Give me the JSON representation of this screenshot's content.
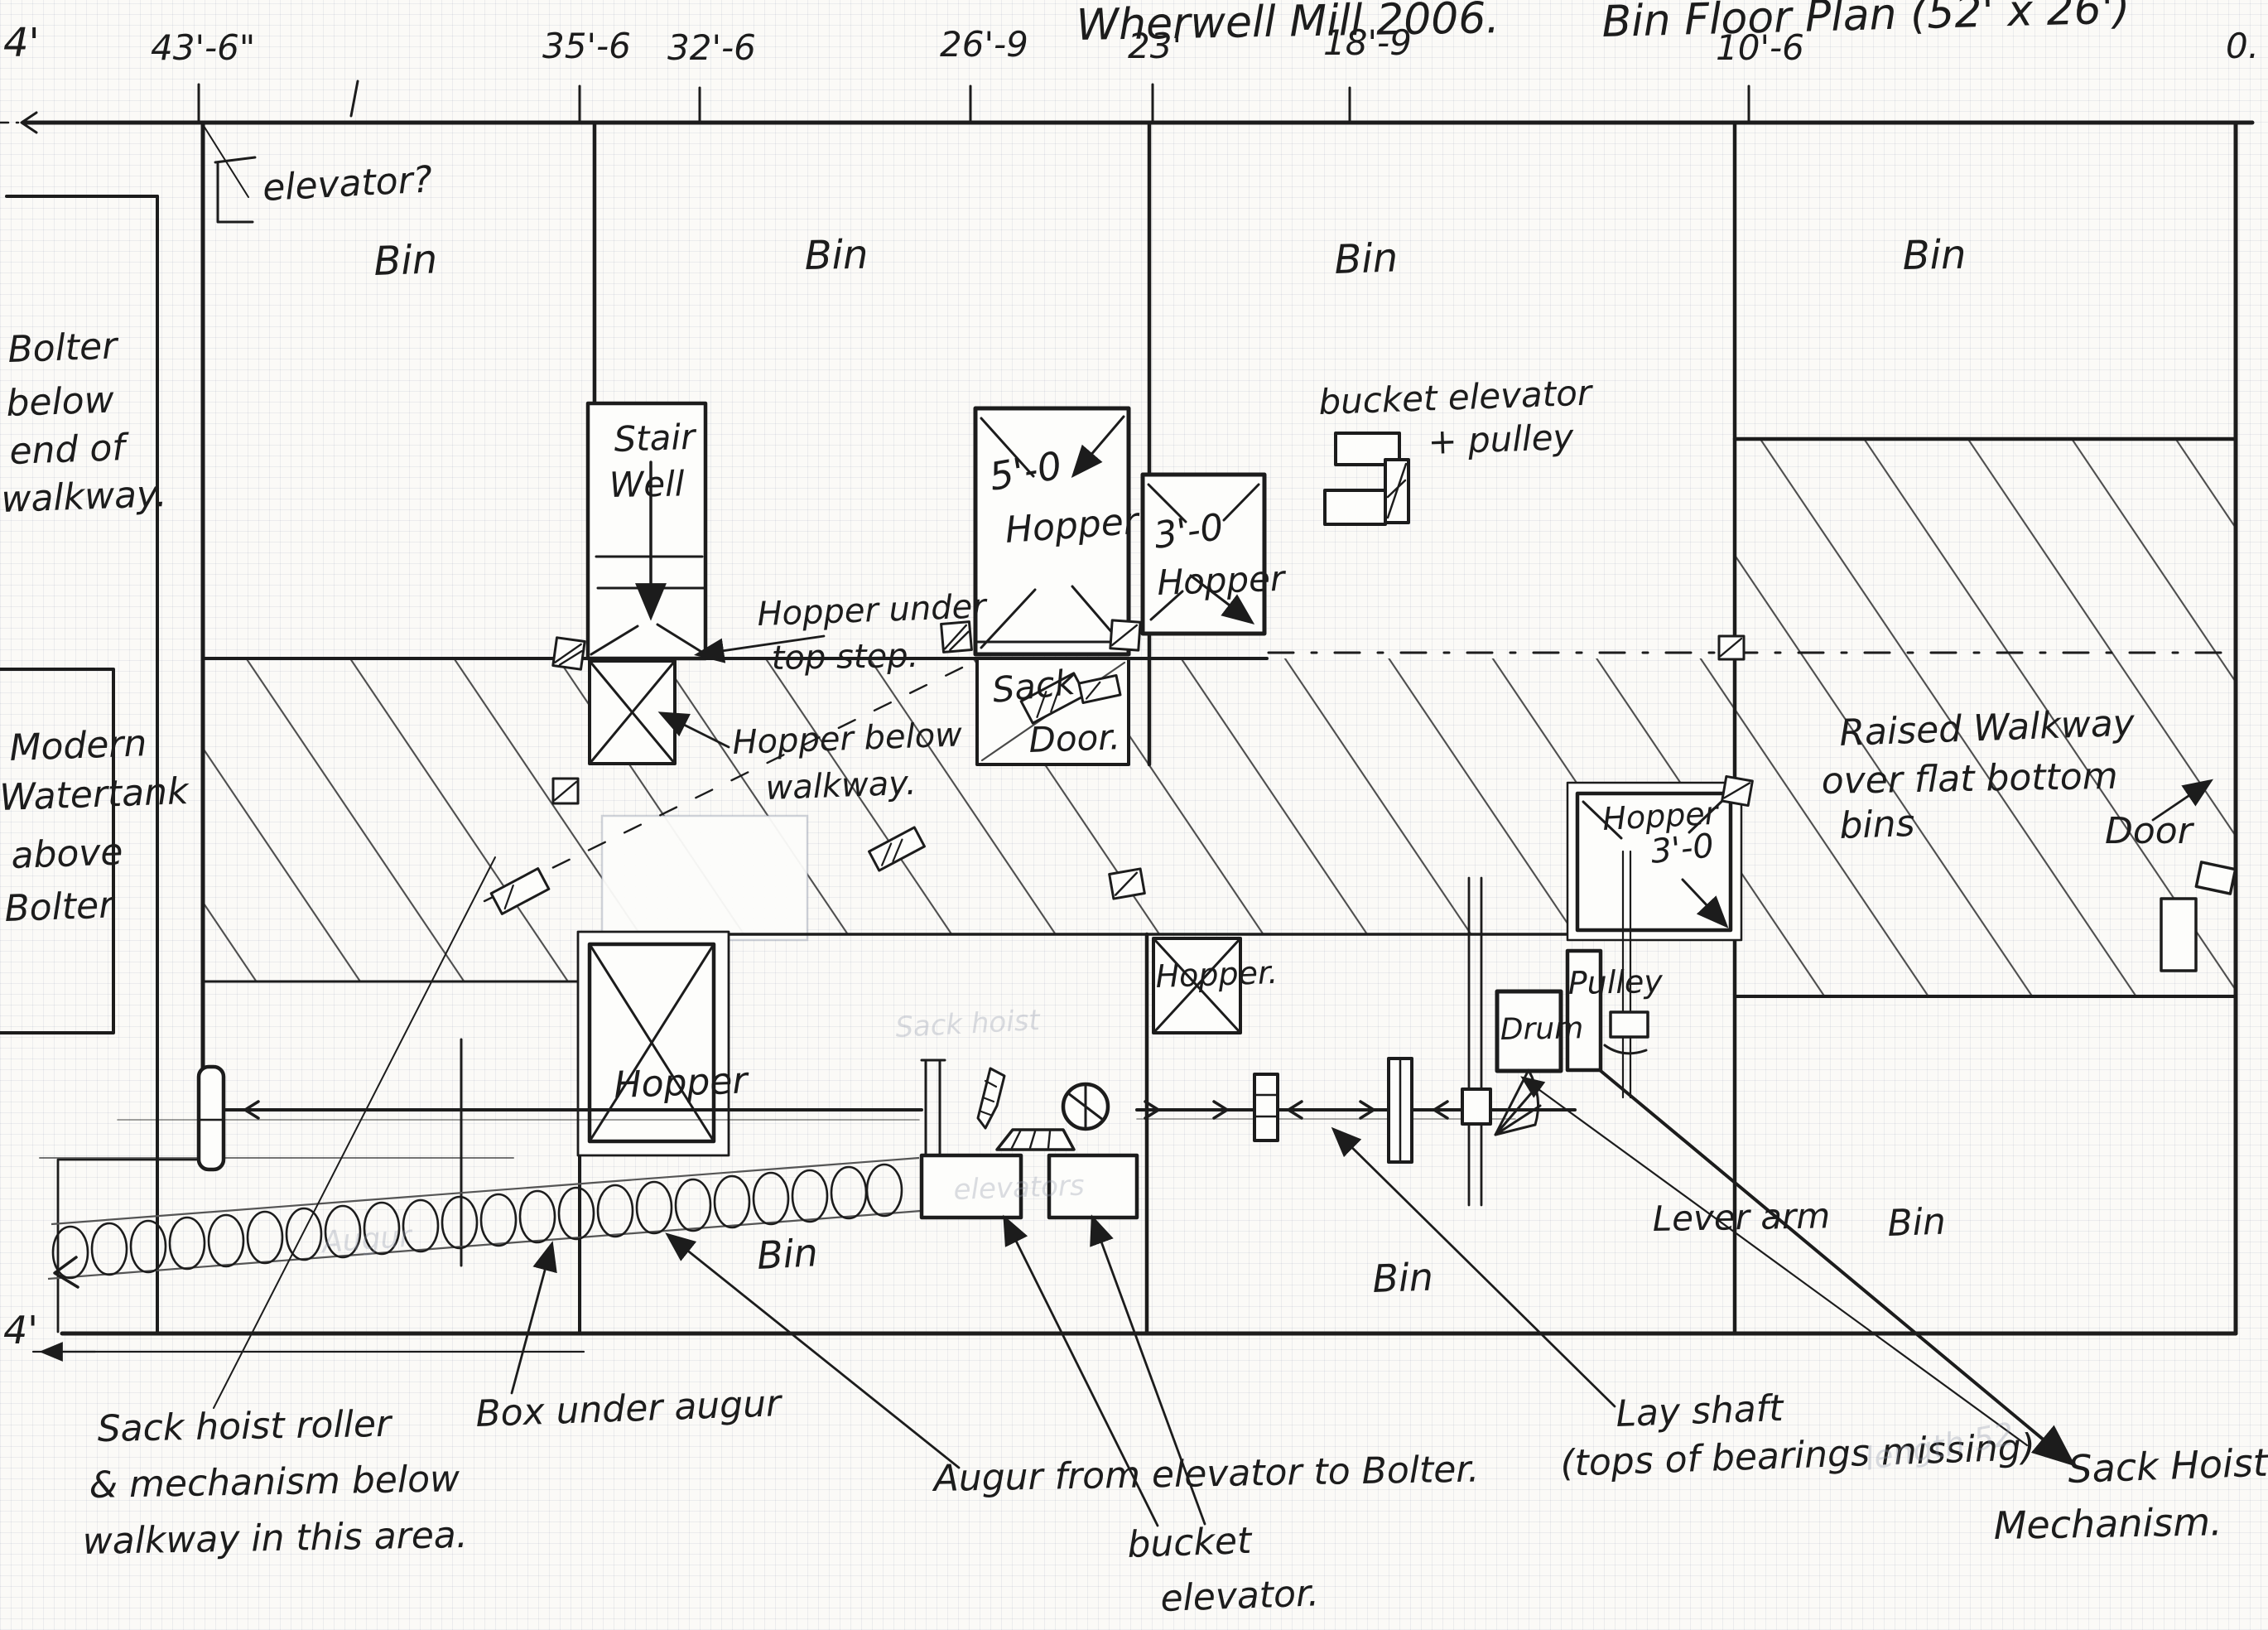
{
  "title": {
    "left": "Wherwell Mill 2006.",
    "right": "Bin Floor Plan (52' x 26')"
  },
  "dimensions": {
    "top_left": "4'",
    "bottom_left": "4'",
    "ticks": [
      "43'-6\"",
      "35'-6",
      "32'-6",
      "26'-9",
      "23'",
      "18'-9",
      "10'-6",
      "0."
    ]
  },
  "bins": {
    "top": [
      "Bin",
      "Bin",
      "Bin",
      "Bin"
    ],
    "bottom": [
      "Bin",
      "Bin",
      "Bin"
    ]
  },
  "rooms": {
    "stair_well": [
      "Stair",
      "Well"
    ],
    "bolter_note": [
      "Bolter",
      "below",
      "end of",
      "walkway."
    ],
    "watertank_note": [
      "Modern",
      "Watertank",
      "above",
      "Bolter"
    ],
    "raised_walkway": [
      "Raised Walkway",
      "over flat bottom",
      "bins"
    ]
  },
  "features": {
    "elevator_query": "elevator?",
    "hopper_under_step": [
      "Hopper under",
      "top step."
    ],
    "hopper_below_walkway": [
      "Hopper below",
      "walkway."
    ],
    "hopper_5ft": [
      "5'-0",
      "Hopper"
    ],
    "hopper_3ft": [
      "3'-0",
      "Hopper"
    ],
    "sack_door": [
      "Sack",
      "Door."
    ],
    "bucket_elevator_pulley": [
      "bucket elevator",
      "+ pulley"
    ],
    "door_right": "Door",
    "hopper_3ft_right": [
      "Hopper",
      "3'-0"
    ],
    "hopper_mid": "Hopper.",
    "drum": "Drum",
    "pulley": "Pulley",
    "hopper_lower": "Hopper",
    "lever_arm": "Lever arm"
  },
  "annotations": {
    "box_under_augur": "Box under augur",
    "augur_note": "Augur from elevator to Bolter.",
    "lay_shaft": [
      "Lay shaft",
      "(tops of bearings missing)"
    ],
    "bucket_elevator": [
      "bucket",
      "elevator."
    ],
    "sack_hoist_mech": [
      "Sack Hoist",
      "Mechanism."
    ],
    "sack_hoist_roller": [
      "Sack hoist roller",
      "& mechanism below",
      "walkway in this area."
    ]
  },
  "ghost_texts": {
    "augur": "Augur",
    "elevators": "elevators",
    "sack_hoist": "Sack hoist",
    "length": "length 52"
  },
  "colors": {
    "ink": "#1c1c1c",
    "hatch": "#4d4d4d",
    "paper": "#fbfaf7",
    "grid": "#d9dde8"
  }
}
